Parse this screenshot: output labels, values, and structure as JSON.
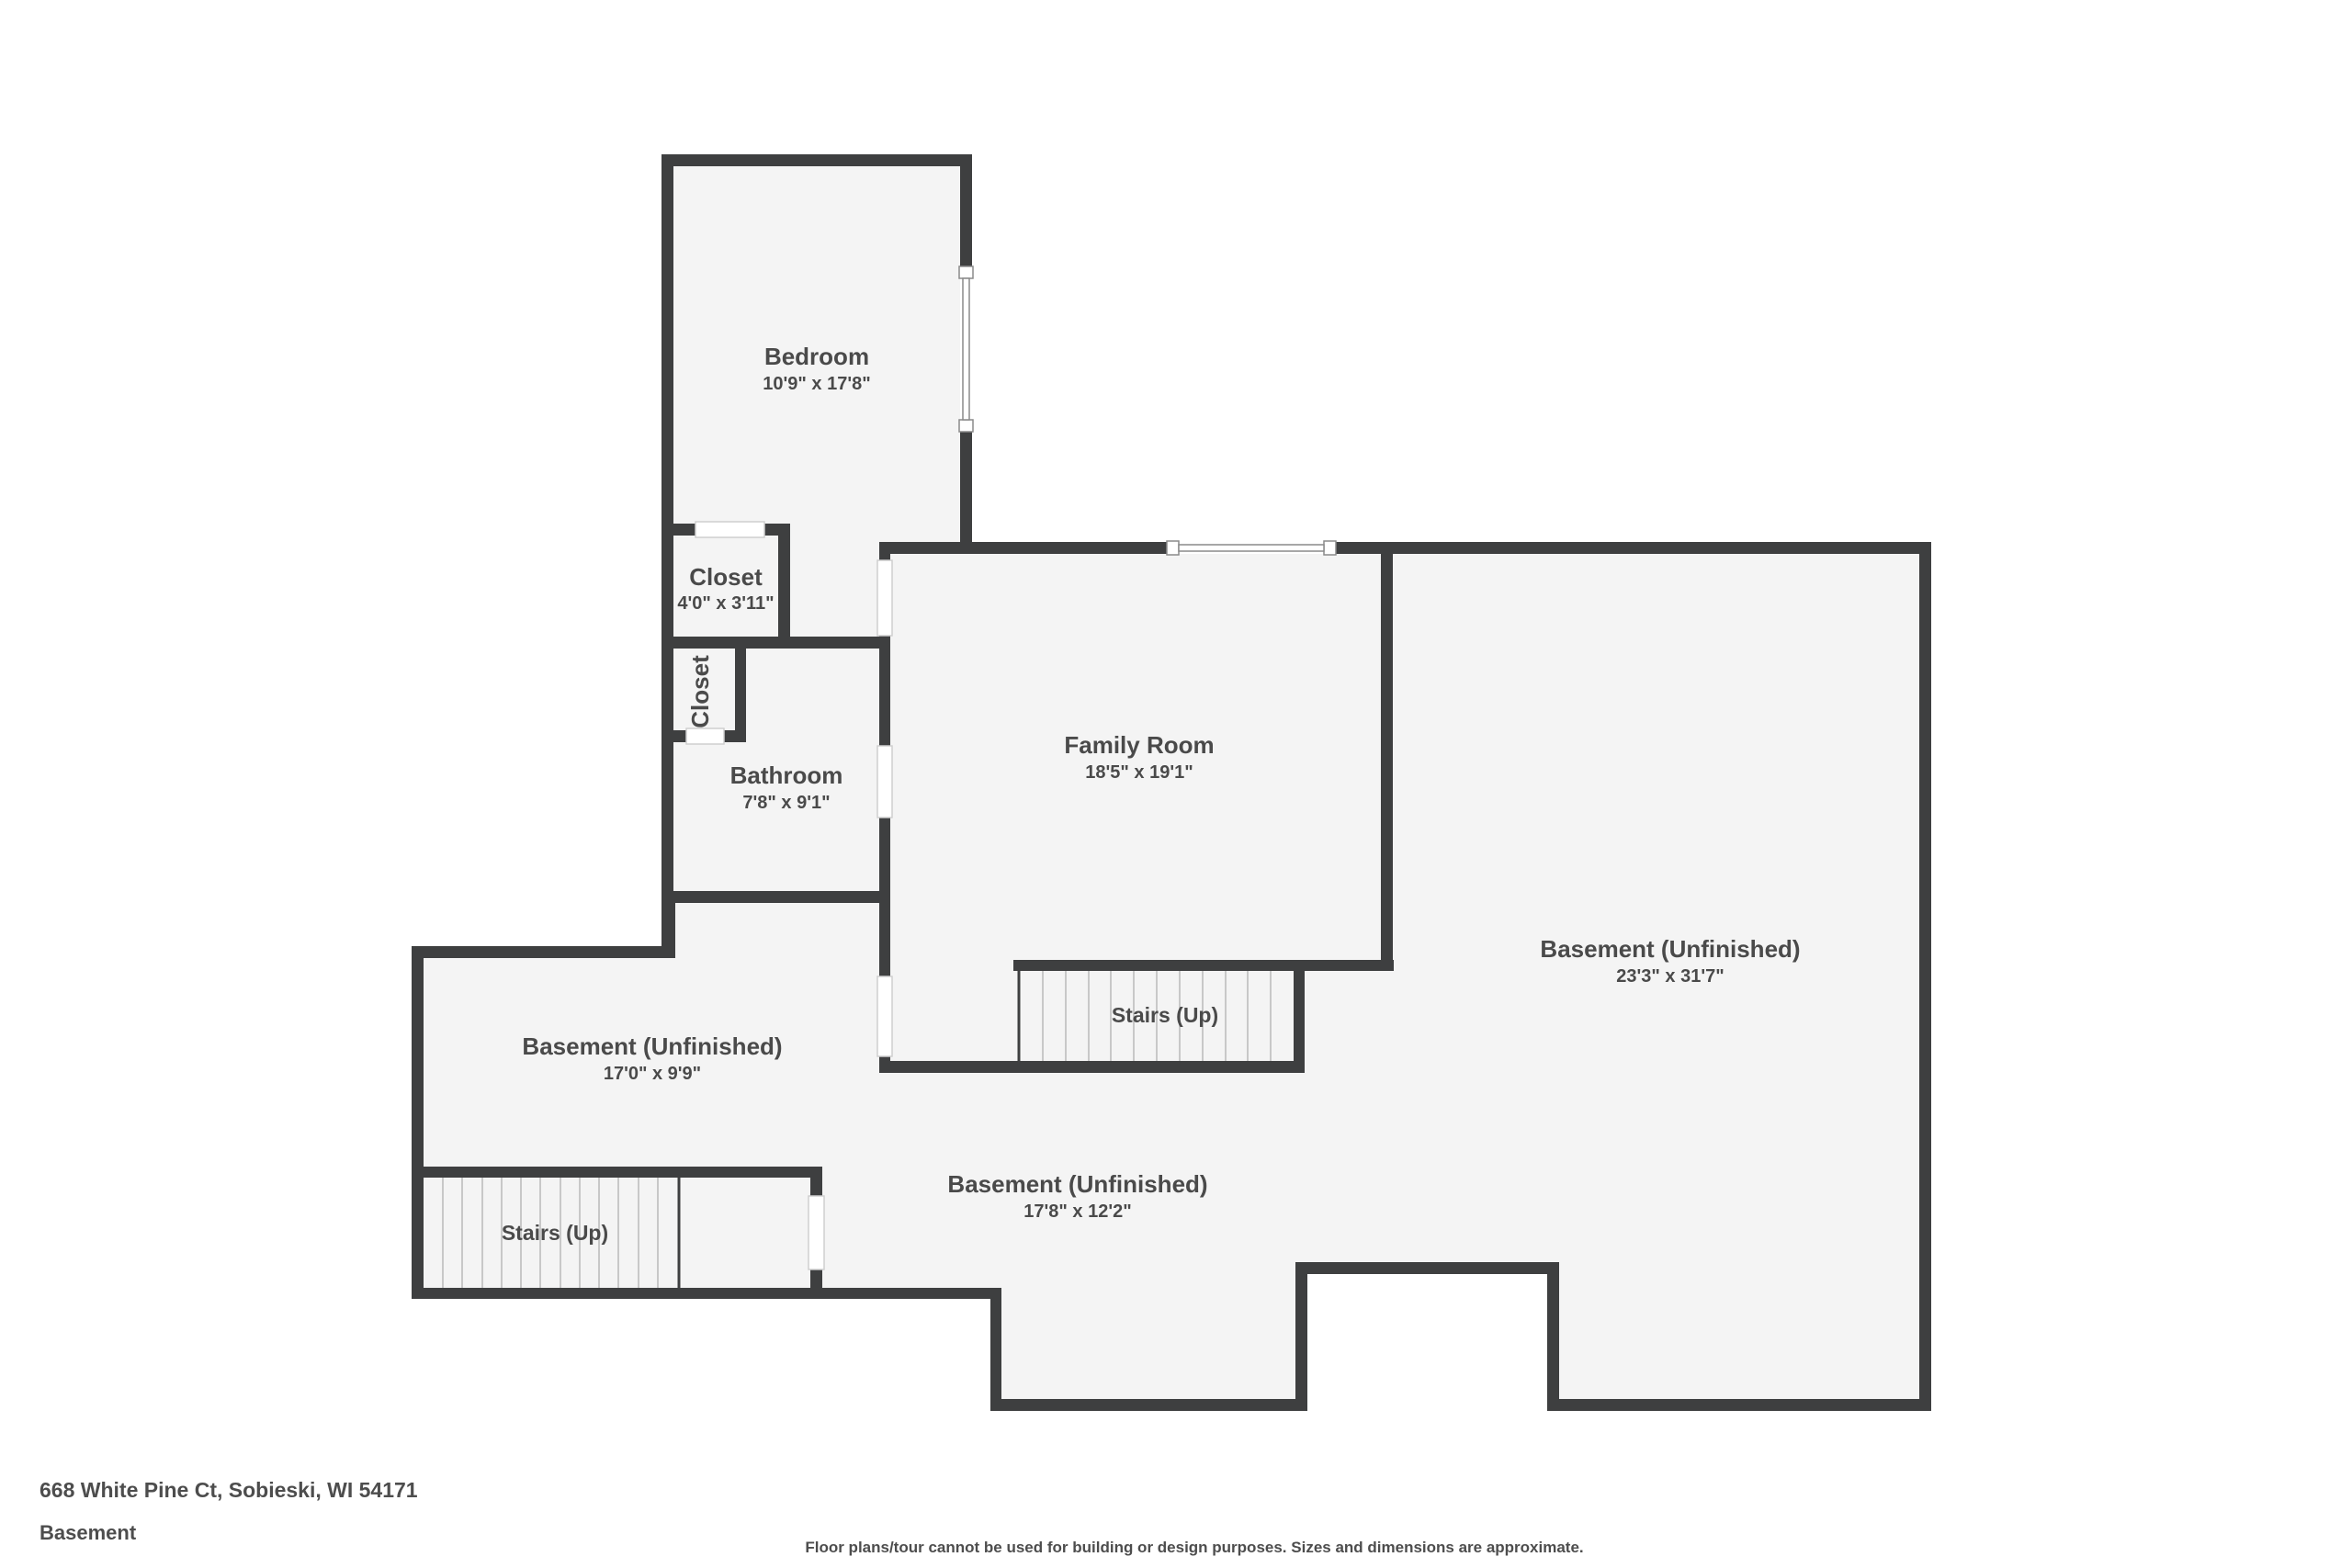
{
  "title_block": {
    "address": "668 White Pine Ct, Sobieski, WI 54171",
    "floor": "Basement"
  },
  "disclaimer": "Floor plans/tour cannot be used for building or design purposes. Sizes and dimensions are approximate.",
  "colors": {
    "wall": "#3e3f40",
    "floor": "#f4f4f4",
    "background": "#ffffff",
    "label_text": "#4a4a4a",
    "stair_tread": "#c8c8c8",
    "window_frame": "#8a8a8a"
  },
  "rooms": {
    "bedroom": {
      "name": "Bedroom",
      "dims": "10'9\" x 17'8\""
    },
    "closet": {
      "name": "Closet",
      "dims": "4'0\" x 3'11\""
    },
    "closet_small": {
      "name": "Closet"
    },
    "bathroom": {
      "name": "Bathroom",
      "dims": "7'8\" x 9'1\""
    },
    "family_room": {
      "name": "Family Room",
      "dims": "18'5\" x 19'1\""
    },
    "basement_right": {
      "name": "Basement (Unfinished)",
      "dims": "23'3\" x 31'7\""
    },
    "basement_left": {
      "name": "Basement (Unfinished)",
      "dims": "17'0\" x 9'9\""
    },
    "basement_middle": {
      "name": "Basement (Unfinished)",
      "dims": "17'8\" x 12'2\""
    },
    "stairs_middle": {
      "name": "Stairs (Up)"
    },
    "stairs_bottom": {
      "name": "Stairs (Up)"
    }
  }
}
